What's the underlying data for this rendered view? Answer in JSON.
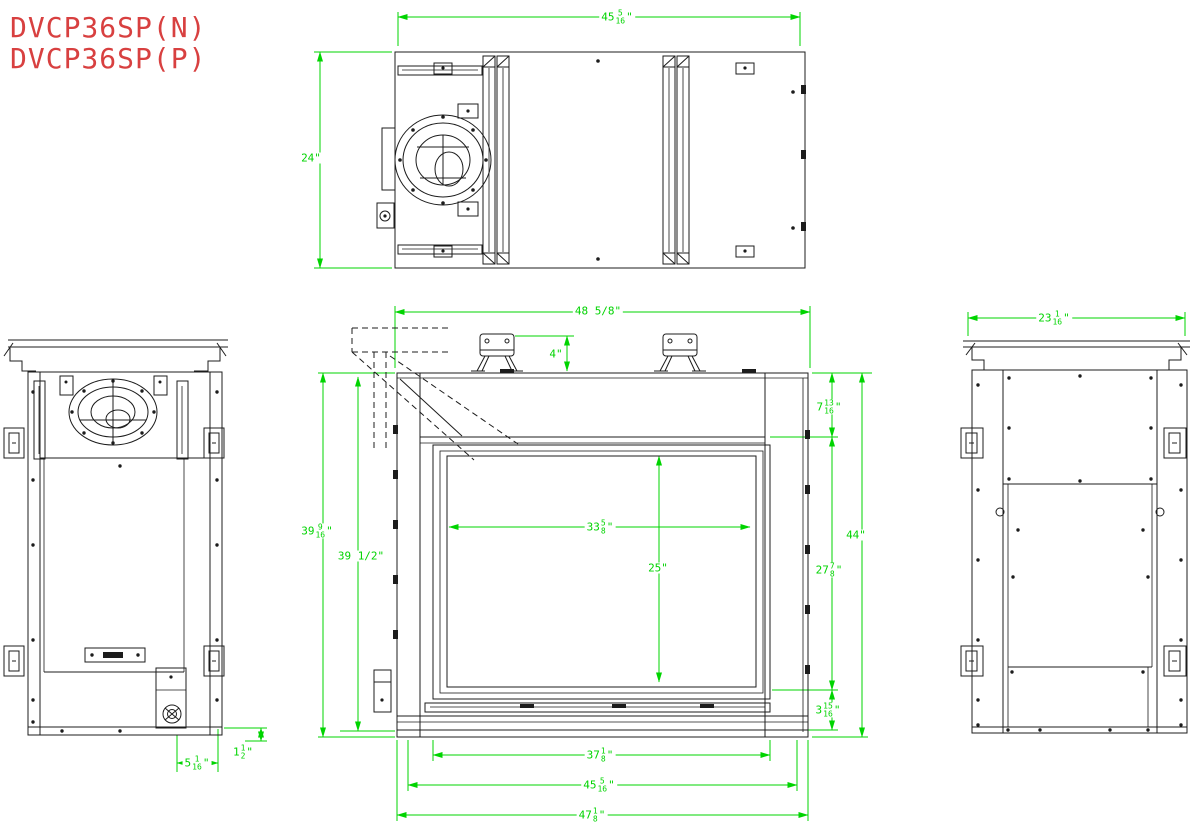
{
  "title": {
    "model_line1": "DVCP36SP(N)",
    "model_line2": "DVCP36SP(P)"
  },
  "colors": {
    "dimension_green": "#00d400",
    "line_black": "#1c1c1c",
    "title_red": "#d84040",
    "background": "#ffffff"
  },
  "dimensions": {
    "top_width": {
      "whole": "45",
      "num": "5",
      "den": "16",
      "unit": "\""
    },
    "top_depth": {
      "text": "24\""
    },
    "front_width_top": {
      "text": "48 5/8\""
    },
    "bracket_height": {
      "text": "4\""
    },
    "header_height": {
      "whole": "7",
      "num": "13",
      "den": "16",
      "unit": "\""
    },
    "overall_height": {
      "text": "44\""
    },
    "firebox_front_height": {
      "whole": "27",
      "num": "7",
      "den": "8",
      "unit": "\""
    },
    "base_height": {
      "whole": "3",
      "num": "15",
      "den": "16",
      "unit": "\""
    },
    "glass_width": {
      "whole": "33",
      "num": "5",
      "den": "8",
      "unit": "\""
    },
    "glass_height": {
      "text": "25\""
    },
    "height_outer": {
      "whole": "39",
      "num": "9",
      "den": "16",
      "unit": "\""
    },
    "height_inner": {
      "text": "39 1/2\""
    },
    "bottom_width_inner": {
      "whole": "37",
      "num": "1",
      "den": "8",
      "unit": "\""
    },
    "bottom_width_mid": {
      "whole": "45",
      "num": "5",
      "den": "16",
      "unit": "\""
    },
    "bottom_width_outer": {
      "whole": "47",
      "num": "1",
      "den": "8",
      "unit": "\""
    },
    "gas_inlet_offset": {
      "whole": "5",
      "num": "1",
      "den": "16",
      "unit": "\""
    },
    "gas_inlet_height": {
      "whole": "1",
      "num": "1",
      "den": "2",
      "unit": "\""
    },
    "rear_width": {
      "whole": "23",
      "num": "1",
      "den": "16",
      "unit": "\""
    }
  }
}
